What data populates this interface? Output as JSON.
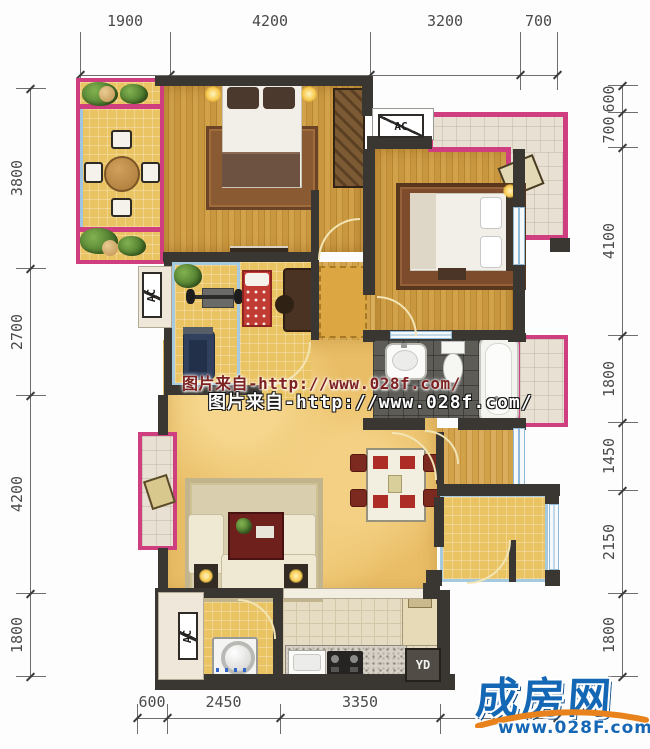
{
  "watermark": {
    "line1": "图片来自-http://www.028f.com/",
    "line2": "图片来自-http://www.028f.com/"
  },
  "logo": {
    "title": "成房网",
    "url": "www.028F.com",
    "title_color": "#1467b5",
    "swoosh_color": "#e8821c"
  },
  "labels": {
    "ac": "AC",
    "yd": "YD"
  },
  "dimensions": {
    "top": {
      "axis": "h",
      "line": 75,
      "ticks": [
        80,
        170,
        370,
        520,
        557
      ],
      "labels": [
        "1900",
        "4200",
        "3200",
        "700"
      ]
    },
    "bottom": {
      "axis": "h",
      "line": 718,
      "ticks": [
        137,
        167,
        280,
        440,
        557
      ],
      "labels": [
        "600",
        "2450",
        "3350",
        ""
      ]
    },
    "left": {
      "axis": "v",
      "line": 30,
      "ticks": [
        88,
        268,
        395,
        593,
        676
      ],
      "labels": [
        "3800",
        "2700",
        "4200",
        "1800"
      ]
    },
    "right": {
      "axis": "v",
      "line": 622,
      "ticks": [
        85,
        112,
        147,
        335,
        422,
        490,
        593,
        676
      ],
      "labels": [
        "600",
        "700",
        "4100",
        "1800",
        "1450",
        "2150",
        "1800"
      ]
    }
  }
}
